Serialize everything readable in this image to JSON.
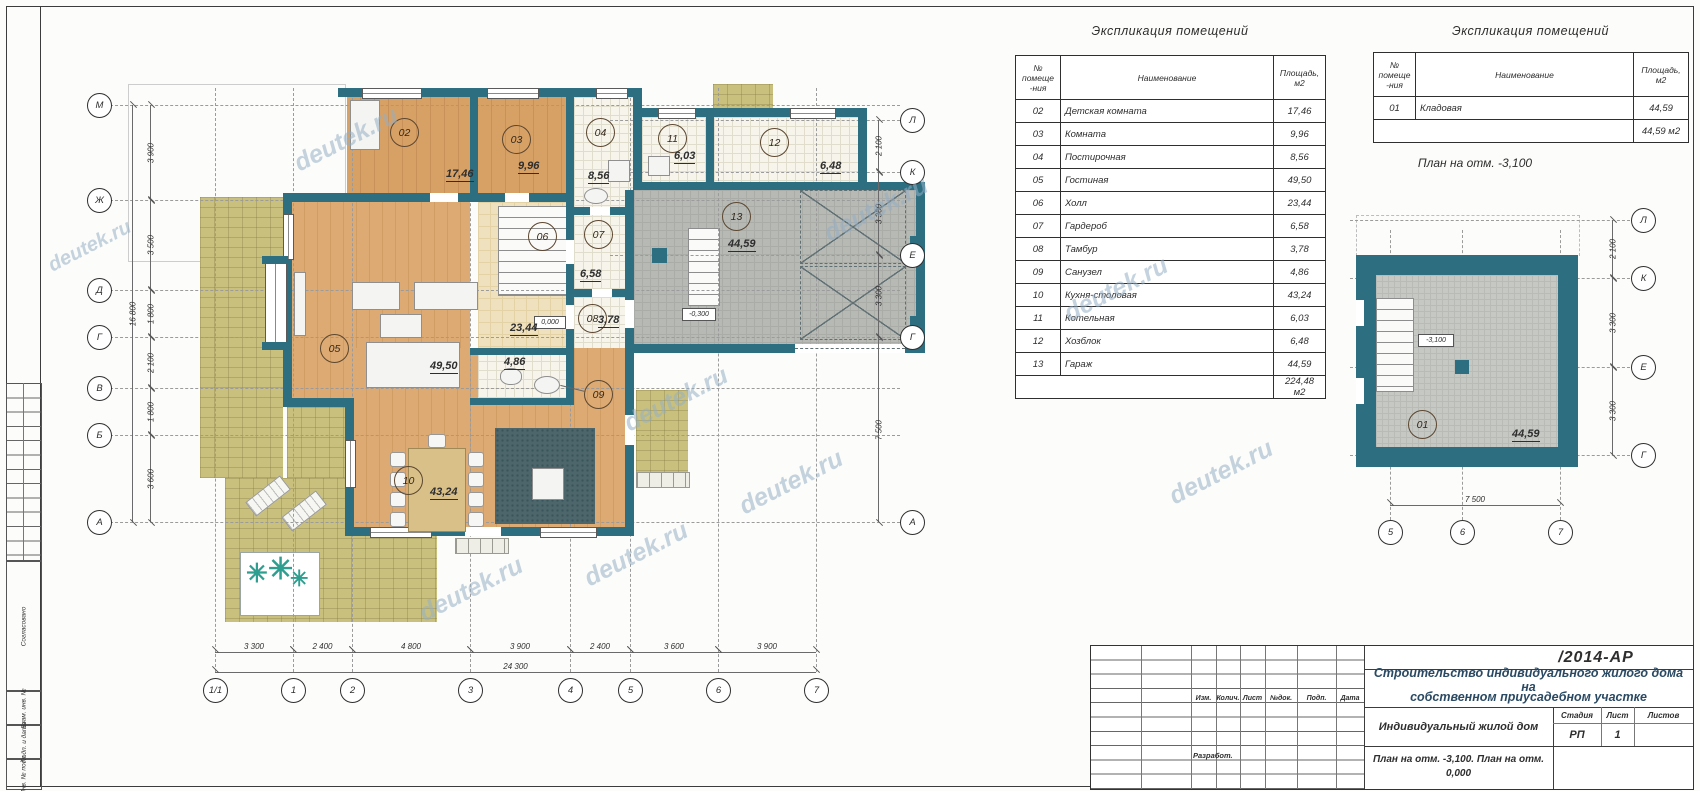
{
  "watermark": "deutek.ru",
  "left_margin": {
    "stamps": [
      "Согласовано",
      "Взам. инв. №",
      "Подп. и дата",
      "Инв. № подл."
    ]
  },
  "tables": {
    "main": {
      "title": "Экспликация помещений",
      "header": {
        "num": "№ помеще -ния",
        "name": "Наименование",
        "area": "Площадь, м2"
      },
      "rows": [
        {
          "num": "02",
          "name": "Детская комната",
          "area": "17,46"
        },
        {
          "num": "03",
          "name": "Комната",
          "area": "9,96"
        },
        {
          "num": "04",
          "name": "Постирочная",
          "area": "8,56"
        },
        {
          "num": "05",
          "name": "Гостиная",
          "area": "49,50"
        },
        {
          "num": "06",
          "name": "Холл",
          "area": "23,44"
        },
        {
          "num": "07",
          "name": "Гардероб",
          "area": "6,58"
        },
        {
          "num": "08",
          "name": "Тамбур",
          "area": "3,78"
        },
        {
          "num": "09",
          "name": "Санузел",
          "area": "4,86"
        },
        {
          "num": "10",
          "name": "Кухня-столовая",
          "area": "43,24"
        },
        {
          "num": "11",
          "name": "Котельная",
          "area": "6,03"
        },
        {
          "num": "12",
          "name": "Хозблок",
          "area": "6,48"
        },
        {
          "num": "13",
          "name": "Гараж",
          "area": "44,59"
        }
      ],
      "total": "224,48 м2"
    },
    "basement": {
      "title": "Экспликация помещений",
      "header": {
        "num": "№ помеще -ния",
        "name": "Наименование",
        "area": "Площадь, м2"
      },
      "rows": [
        {
          "num": "01",
          "name": "Кладовая",
          "area": "44,59"
        }
      ],
      "total": "44,59 м2"
    }
  },
  "basement_plan": {
    "title": "План на отм. -3,100",
    "room": {
      "num": "01",
      "area": "44,59"
    },
    "elevation": "-3,100",
    "dim_width": "7 500",
    "axes_bottom": [
      "5",
      "6",
      "7"
    ],
    "axes_right": [
      "Л",
      "К",
      "Е",
      "Г"
    ],
    "dims_right": [
      "2 100",
      "3 300",
      "3 300"
    ]
  },
  "main_plan": {
    "rooms": {
      "r02": {
        "num": "02",
        "area": "17,46"
      },
      "r03": {
        "num": "03",
        "area": "9,96"
      },
      "r04": {
        "num": "04",
        "area": "8,56"
      },
      "r05": {
        "num": "05",
        "area": "49,50"
      },
      "r06": {
        "num": "06",
        "area": "23,44"
      },
      "r07": {
        "num": "07",
        "area": "6,58"
      },
      "r08": {
        "num": "08",
        "area": "3,78"
      },
      "r09": {
        "num": "09",
        "area": "4,86"
      },
      "r10": {
        "num": "10",
        "area": "43,24"
      },
      "r11": {
        "num": "11",
        "area": "6,03"
      },
      "r12": {
        "num": "12",
        "area": "6,48"
      },
      "r13": {
        "num": "13",
        "area": "44,59"
      }
    },
    "elev_zero": "0,000",
    "elev_garage": "-0,300",
    "axes_left": [
      "М",
      "Ж",
      "Д",
      "Г",
      "В",
      "Б",
      "А"
    ],
    "axes_right": [
      "Л",
      "К",
      "Е",
      "Г",
      "А"
    ],
    "axes_bottom": [
      "1/1",
      "1",
      "2",
      "3",
      "4",
      "5",
      "6",
      "7"
    ],
    "dims_bottom": [
      "3 300",
      "2 400",
      "4 800",
      "3 900",
      "2 400",
      "3 600",
      "3 900"
    ],
    "dim_total_bottom": "24 300",
    "dims_left": [
      "3 900",
      "3 500",
      "1 800",
      "2 100",
      "1 800",
      "3 600"
    ],
    "dim_total_left": "16 800",
    "dims_right": [
      "2 100",
      "3 300",
      "3 300",
      "7 500"
    ]
  },
  "titleblock": {
    "doc_number": "/2014-АР",
    "project_line1": "Строительство индивидуального жилого дома на",
    "project_line2": "собственном приусадебном участке",
    "object_name": "Индивидуальный жилой дом",
    "sheet_title_line1": "План на отм. -3,100. План на отм.",
    "sheet_title_line2": "0,000",
    "stage_label": "Стадия",
    "sheet_label": "Лист",
    "sheets_label": "Листов",
    "stage_value": "РП",
    "sheet_value": "1",
    "sheets_value": "",
    "header_cols": [
      "Изм.",
      "Колич.",
      "Лист",
      "№док.",
      "Подп.",
      "Дата"
    ],
    "razrabot": "Разработ."
  }
}
